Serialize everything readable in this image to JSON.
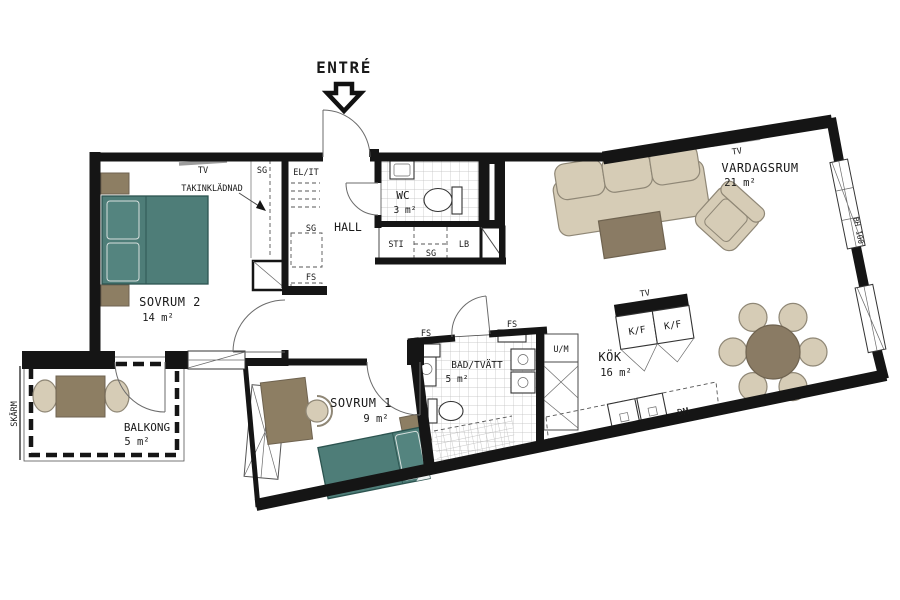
{
  "plan": {
    "entry": {
      "label": "ENTRÉ"
    },
    "rooms": {
      "vardagsrum": {
        "name": "VARDAGSRUM",
        "area": "21 m²"
      },
      "sovrum2": {
        "name": "SOVRUM 2",
        "area": "14 m²"
      },
      "sovrum1": {
        "name": "SOVRUM 1",
        "area": "9 m²"
      },
      "kok": {
        "name": "KÖK",
        "area": "16 m²"
      },
      "bad": {
        "name": "BAD/TVÄTT",
        "area": "5 m²"
      },
      "wc": {
        "name": "WC",
        "area": "3 m²"
      },
      "hall": {
        "name": "HALL"
      },
      "balkong": {
        "name": "BALKONG",
        "area": "5 m²"
      }
    },
    "labels": {
      "tv_sovrum2": "TV",
      "tv_vardagsrum": "TV",
      "tv_kok": "TV",
      "takinkladnad": "TAKINKLÄDNAD",
      "sg_sovrum2": "SG",
      "sg_hall": "SG",
      "sg_forrad": "SG",
      "el_it": "EL/IT",
      "fs_hall": "FS",
      "fs_bad_left": "FS",
      "fs_bad_right": "FS",
      "sti": "STI",
      "lb": "LB",
      "um": "U/M",
      "kf_left": "K/F",
      "kf_right": "K/F",
      "dm": "DM",
      "bh": "BH 100",
      "skarm": "SKÄRM"
    },
    "colors": {
      "wall": "#151515",
      "bed_teal": "#4e7d78",
      "wood_brown": "#8d7e63",
      "upholstery_beige": "#d6ccb6",
      "table_dark": "#8a7b64",
      "tile_line": "#bdbdbd"
    }
  }
}
